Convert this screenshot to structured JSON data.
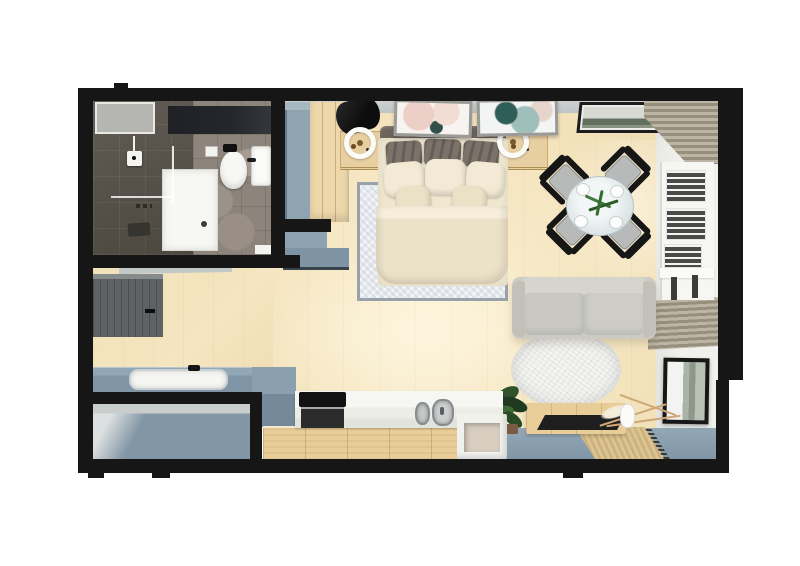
{
  "meta": {
    "kind": "3d-floor-plan-render",
    "width": 800,
    "height": 566,
    "visible_text": "none"
  },
  "palette": {
    "bg": "#ffffff",
    "wallBlack": "#161616",
    "woodFloor": "#f5e5c0",
    "woodFloorEdge": "#eeddb2",
    "woodCabinet": "#e9cd99",
    "woodWarm": "#eed8ab",
    "woodNight": "#e7cfa2",
    "steelBlue": "#8fa3b1",
    "steelBlueDark": "#7f95a6",
    "steelBlueFloor": "#8296a5",
    "steelBlueStrip": "#8196a6",
    "grayWallFace": "#cdd1d1",
    "whiteWallFace": "#f0f0ec",
    "bathTileDark": "#565149",
    "bathTileLight": "#8d847b",
    "bathVanityDark": "#24262b",
    "pureWhite": "#f7f7f4",
    "darkWardrobe": "#5e6264",
    "sofaGray": "#cbcbc4",
    "sofaGrayDark": "#c1c1ba",
    "rugBlue": "#e7ebf0",
    "rugBorder": "#99a2ab",
    "rugRoundWhite": "#f4f4f1",
    "slatTan": "#bdb5a4",
    "slatTanDark": "#978f7e",
    "bedCream": "#f0e7d0",
    "bedCreamDeep": "#ece2c8",
    "pillowDark": "#7b7269",
    "headboardBrown": "#6d645d",
    "chairBlack": "#161616",
    "seatGray": "#b7bab9",
    "tanMat": "#dcc493"
  },
  "scene": {
    "title": "studio-apartment-top-down-3d-floor-plan",
    "rooms": [
      {
        "name": "bathroom",
        "items": [
          "walk-in-shower",
          "glass-partition",
          "toilet",
          "flush-plate",
          "wash-basin",
          "vanity-counter",
          "wall-shelf",
          "shower-control",
          "bath-mat",
          "toilet-paper-holder"
        ]
      },
      {
        "name": "entry-hall",
        "items": [
          "dark-wardrobe",
          "sliding-door-track",
          "utility-counter-with-white-basin",
          "black-faucet",
          "blue-gray-floor"
        ]
      },
      {
        "name": "sleeping-area",
        "items": [
          "double-bed-cream-bedding",
          "gray-headboard",
          "dark-pillows",
          "cream-pillows",
          "blue-white-area-rug",
          "nightstand-left",
          "nightstand-right",
          "black-bedside-lamp-left",
          "black-bedside-lamp-right",
          "pink-abstract-artwork",
          "teal-abstract-artwork",
          "blue-cabinet",
          "wood-wardrobe",
          "stepped-blue-counter"
        ]
      },
      {
        "name": "dining-area",
        "items": [
          "round-glass-table",
          "four-place-settings",
          "green-plant-centerpiece",
          "black-chair-nw",
          "black-chair-ne",
          "black-chair-sw",
          "black-chair-se",
          "landscape-artwork",
          "corner-vent-slats"
        ]
      },
      {
        "name": "living-area",
        "items": [
          "light-gray-sofa",
          "round-white-rug",
          "wood-media-console",
          "black-tray-top",
          "potted-plant",
          "pampas-in-white-vase",
          "jute-mat",
          "leaning-framed-artwork",
          "slat-vent-panel",
          "blue-gray-floor-strip"
        ]
      },
      {
        "name": "kitchen",
        "items": [
          "white-countertop",
          "black-cooktop",
          "oven-front",
          "stainless-double-sink",
          "wood-cabinet-fronts",
          "open-shelf-unit",
          "blue-peninsula-counter"
        ]
      },
      {
        "name": "right-wall",
        "items": [
          "louvered-window-shutters",
          "window-sill",
          "window-mullions",
          "white-wall-face"
        ]
      }
    ]
  }
}
